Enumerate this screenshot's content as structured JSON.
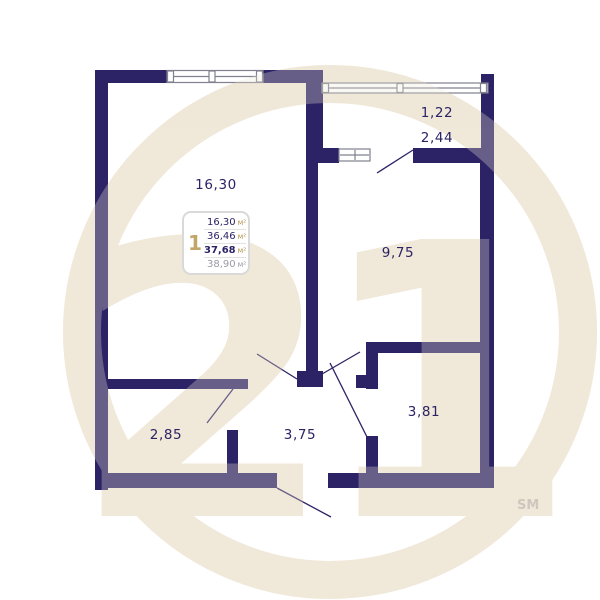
{
  "watermark": {
    "number": "21",
    "service_mark": "SM"
  },
  "info_box": {
    "rooms_count": "1",
    "rows": [
      {
        "value": "16,30",
        "unit": "м²"
      },
      {
        "value": "36,46",
        "unit": "м²"
      },
      {
        "value": "37,68",
        "unit": "м²"
      },
      {
        "value": "38,90",
        "unit": "м²"
      }
    ]
  },
  "room_labels": {
    "living_room": "16,30",
    "bedroom": "9,75",
    "bathroom": "2,85",
    "hallway": "3,75",
    "kitchen": "3,81",
    "balcony_reduced": "1,22",
    "balcony_full": "2,44"
  },
  "colors": {
    "wall_navy": "#2b2365",
    "watermark_beige": "#f0e8d8",
    "accent_gold": "#c2a568",
    "muted_gray": "#9b9ba8",
    "background": "#ffffff"
  }
}
